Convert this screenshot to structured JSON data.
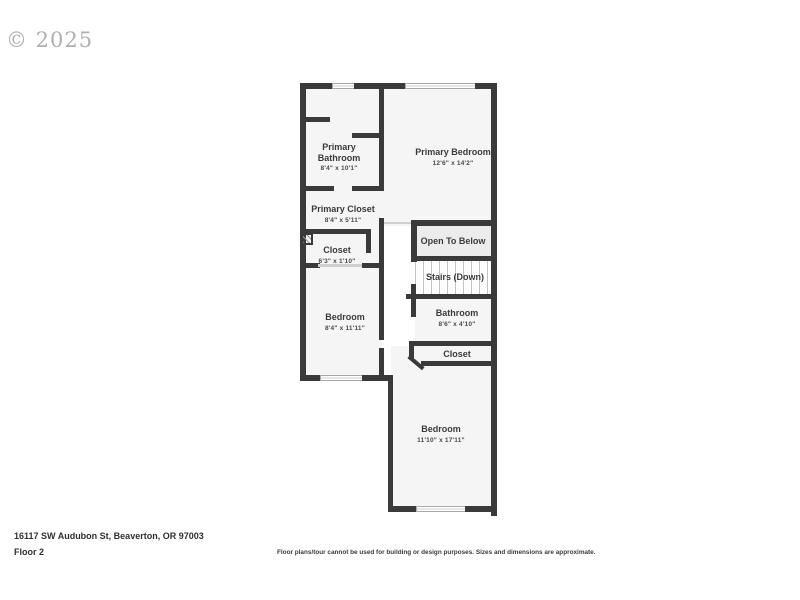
{
  "watermark": "© 2025",
  "floorplan": {
    "rooms": [
      {
        "name": "Primary Bathroom",
        "dims": "8'4\" x 10'1\""
      },
      {
        "name": "Primary Bedroom",
        "dims": "12'6\" x 14'2\""
      },
      {
        "name": "Primary Closet",
        "dims": "8'4\" x 5'11\""
      },
      {
        "name": "Closet",
        "dims": "6'3\" x 1'10\""
      },
      {
        "name": "Open To Below",
        "dims": ""
      },
      {
        "name": "Stairs (Down)",
        "dims": ""
      },
      {
        "name": "Bedroom",
        "dims": "8'4\" x 11'11\""
      },
      {
        "name": "Bathroom",
        "dims": "8'6\" x 4'10\""
      },
      {
        "name": "Closet",
        "dims": ""
      },
      {
        "name": "Bedroom",
        "dims": "11'10\" x 17'11\""
      }
    ]
  },
  "footer": {
    "address": "16117 SW Audubon St, Beaverton, OR 97003",
    "floor_label": "Floor 2",
    "disclaimer": "Floor plans/tour cannot be used for building or design purposes. Sizes and dimensions are approximate."
  },
  "colors": {
    "wall": "#3a3a3a",
    "room_fill": "#f5f5f5",
    "open_below_fill": "#ececec",
    "text": "#3b3b3b",
    "watermark_gray": "#6e6e6e"
  }
}
